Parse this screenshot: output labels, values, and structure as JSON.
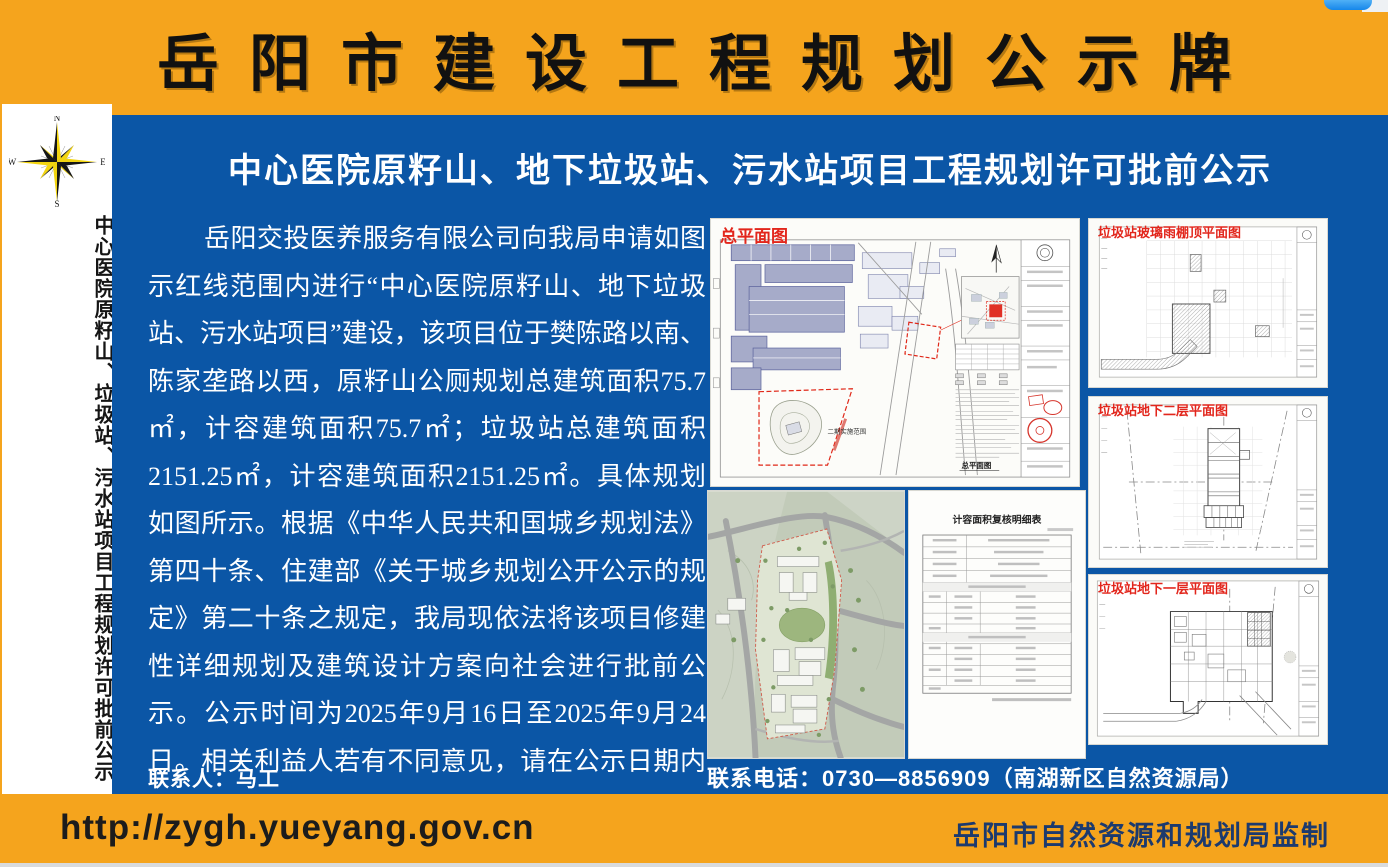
{
  "header": {
    "title": "岳阳市建设工程规划公示牌"
  },
  "sidebar": {
    "compass": {
      "n": "N",
      "e": "E",
      "s": "S",
      "w": "W"
    },
    "vertical_title": "中心医院原籽山、垃圾站、污水站项目工程规划许可批前公示"
  },
  "main": {
    "title": "中心医院原籽山、地下垃圾站、污水站项目工程规划许可批前公示",
    "body": "岳阳交投医养服务有限公司向我局申请如图示红线范围内进行“中心医院原籽山、地下垃圾站、污水站项目”建设，该项目位于樊陈路以南、陈家垄路以西，原籽山公厕规划总建筑面积75.7㎡，计容建筑面积75.7㎡；垃圾站总建筑面积2151.25㎡，计容建筑面积2151.25㎡。具体规划如图所示。根据《中华人民共和国城乡规划法》第四十条、住建部《关于城乡规划公开公示的规定》第二十条之规定，我局现依法将该项目修建性详细规划及建筑设计方案向社会进行批前公示。公示时间为2025年9月16日至2025年9月24日。相关利益人若有不同意见，请在公示日期内以书面的形式向我局提出意见或建议，逾期我局不再受理。",
    "contact_person": "联系人：马工",
    "contact_phone": "联系电话：0730—8856909（南湖新区自然资源局）",
    "figures": {
      "master_plan": {
        "label": "总平面图",
        "caption": "总平面图",
        "annotation": "二期实施范围"
      },
      "area_table": {
        "title": "计容面积复核明细表"
      },
      "canopy_plan": {
        "label": "垃圾站玻璃雨棚顶平面图"
      },
      "basement2_plan": {
        "label": "垃圾站地下二层平面图"
      },
      "basement1_plan": {
        "label": "垃圾站地下一层平面图"
      }
    }
  },
  "footer": {
    "url": "http://zygh.yueyang.gov.cn",
    "supervision": "岳阳市自然资源和规划局监制"
  },
  "colors": {
    "board_orange": "#F5A41D",
    "board_blue": "#0B56A6",
    "figure_label_red": "#E2261C",
    "footer_supervision_navy": "#1C3A6E"
  }
}
